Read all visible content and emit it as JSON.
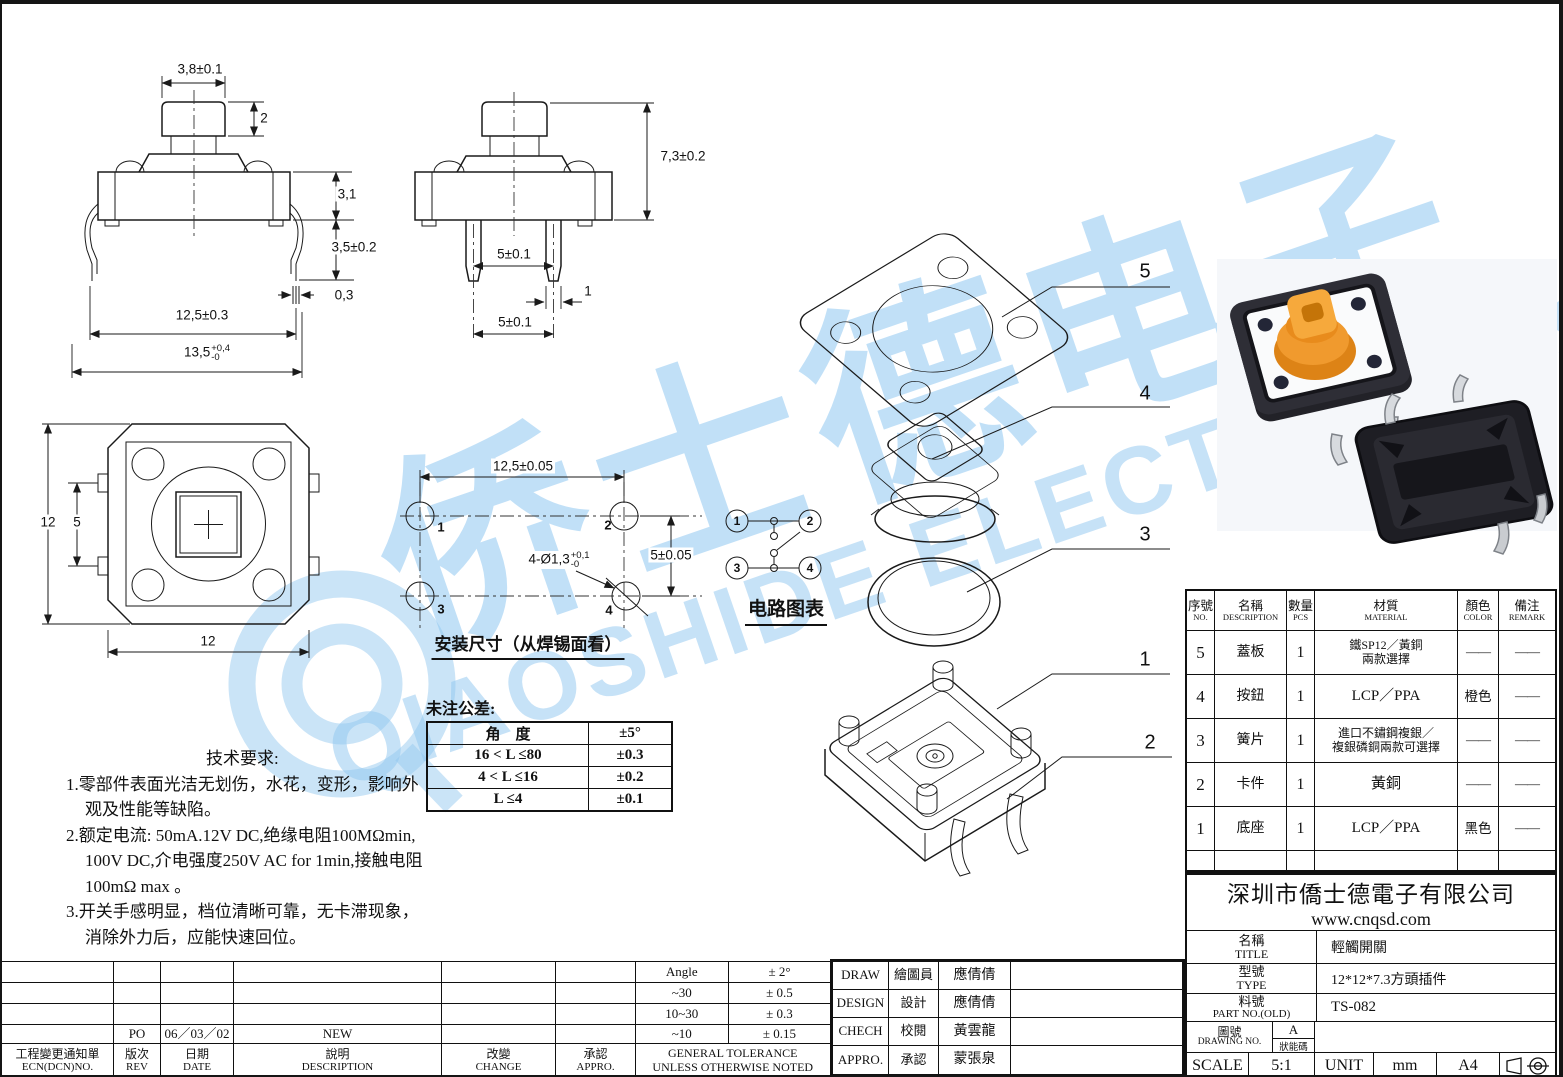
{
  "colors": {
    "line": "#1a1a1a",
    "watermark_blue": "#a9d3f0",
    "button_orange": "#f0952c",
    "base_black": "#25252b"
  },
  "watermark": {
    "cjk": "侨士德电子",
    "latin": "QIAOSHIDE ELECTRONICS"
  },
  "front_view": {
    "cap_width": "3,8±0.1",
    "cap_height": "2",
    "body_height": "3,1",
    "leg_length": "3,5±0.2",
    "leg_thickness": "0,3",
    "pin_pitch": "12,5±0.3",
    "overall": "13,5",
    "overall_up": "+0,4",
    "overall_low": "-0"
  },
  "side_view": {
    "height": "7,3±0.2",
    "pin_span_upper": "5±0.1",
    "pin_width": "1",
    "pin_span_lower": "5±0.1"
  },
  "top_view": {
    "dim_side": "12",
    "dim_tab": "5",
    "dim_bottom": "12"
  },
  "mounting_view": {
    "caption": "安装尺寸（从焊锡面看）",
    "h_pitch": "12,5±0.05",
    "v_pitch": "5±0.05",
    "hole": "4-Ø1,3",
    "hole_up": "+0,1",
    "hole_low": "-0",
    "pad1": "1",
    "pad2": "2",
    "pad3": "3",
    "pad4": "4"
  },
  "circuit": {
    "caption": "电路图表",
    "t1": "1",
    "t2": "2",
    "t3": "3",
    "t4": "4"
  },
  "untoleranced": {
    "title": "未注公差:",
    "rows": [
      {
        "range": "角　度",
        "tol": "±5°"
      },
      {
        "range": "16 < L ≤80",
        "tol": "±0.3"
      },
      {
        "range": "4 < L ≤16",
        "tol": "±0.2"
      },
      {
        "range": "L ≤4",
        "tol": "±0.1"
      }
    ]
  },
  "tech_req": {
    "title": "技术要求:",
    "lines": [
      "1.零部件表面光洁无划伤，水花，变形，影响外",
      "观及性能等缺陷。",
      "2.额定电流: 50mA.12V DC,绝缘电阻100MΩmin,",
      "100V DC,介电强度250V AC for 1min,接触电阻",
      "100mΩ max 。",
      "3.开关手感明显，档位清晰可靠，无卡滞现象，",
      "消除外力后，应能快速回位。"
    ]
  },
  "exploded": {
    "l5": "5",
    "l4": "4",
    "l3": "3",
    "l1": "1",
    "l2": "2"
  },
  "parts_table": {
    "h_no_cn": "序號",
    "h_no_en": "NO.",
    "h_name_cn": "名稱",
    "h_name_en": "DESCRIPTION",
    "h_qty_cn": "數量",
    "h_qty_en": "PCS",
    "h_mat_cn": "材質",
    "h_mat_en": "MATERIAL",
    "h_color_cn": "顏色",
    "h_color_en": "COLOR",
    "h_rem_cn": "備注",
    "h_rem_en": "REMARK",
    "rows": [
      {
        "no": "5",
        "name": "蓋板",
        "qty": "1",
        "mat1": "鐵SP12／黃銅",
        "mat2": "兩款選擇",
        "color": "——",
        "remark": "——"
      },
      {
        "no": "4",
        "name": "按鈕",
        "qty": "1",
        "mat1": "LCP／PPA",
        "mat2": "",
        "color": "橙色",
        "remark": "——"
      },
      {
        "no": "3",
        "name": "簧片",
        "qty": "1",
        "mat1": "進口不鏽鋼複銀／",
        "mat2": "複銀磷銅兩款可選擇",
        "color": "——",
        "remark": "——"
      },
      {
        "no": "2",
        "name": "卡件",
        "qty": "1",
        "mat1": "黃銅",
        "mat2": "",
        "color": "——",
        "remark": "——"
      },
      {
        "no": "1",
        "name": "底座",
        "qty": "1",
        "mat1": "LCP／PPA",
        "mat2": "",
        "color": "黑色",
        "remark": "——"
      }
    ]
  },
  "title_block": {
    "company": "深圳市僑士德電子有限公司",
    "website": "www.cnqsd.com",
    "name_cn": "名稱",
    "name_en": "TITLE",
    "name_value": "輕觸開關",
    "type_cn": "型號",
    "type_en": "TYPE",
    "type_value": "12*12*7.3方頭插件",
    "part_cn": "料號",
    "part_en": "PART NO.(OLD)",
    "part_value": "TS-082",
    "dwg_cn": "圖號",
    "dwg_en": "DRAWING NO.",
    "rev": "A",
    "state_label": "狀能碼",
    "scale_label": "SCALE",
    "scale_value": "5:1",
    "unit_label": "UNIT",
    "unit_value": "mm",
    "paper": "A4"
  },
  "revision_table": {
    "ecn_cn": "工程變更通知單",
    "ecn_en": "ECN(DCN)NO.",
    "rev_cn": "版次",
    "rev_en": "REV",
    "date_cn": "日期",
    "date_en": "DATE",
    "desc_cn": "說明",
    "desc_en": "DESCRIPTION",
    "chg_cn": "改變",
    "chg_en": "CHANGE",
    "app_cn": "承認",
    "app_en": "APPRO.",
    "entry_rev": "PO",
    "entry_date": "06／03／02",
    "entry_desc": "NEW"
  },
  "general_tolerance": {
    "cap1": "GENERAL TOLERANCE",
    "cap2": "UNLESS OTHERWISE NOTED",
    "rows": [
      {
        "r": "Angle",
        "t": "± 2°"
      },
      {
        "r": "~30",
        "t": "± 0.5"
      },
      {
        "r": "10~30",
        "t": "± 0.3"
      },
      {
        "r": "~10",
        "t": "± 0.15"
      }
    ]
  },
  "approvals": {
    "rows": [
      {
        "en": "DRAW",
        "cn": "繪圖員",
        "name": "應倩倩"
      },
      {
        "en": "DESIGN",
        "cn": "設計",
        "name": "應倩倩"
      },
      {
        "en": "CHECH",
        "cn": "校閱",
        "name": "黃雲龍"
      },
      {
        "en": "APPRO.",
        "cn": "承認",
        "name": "蒙張泉"
      }
    ]
  }
}
